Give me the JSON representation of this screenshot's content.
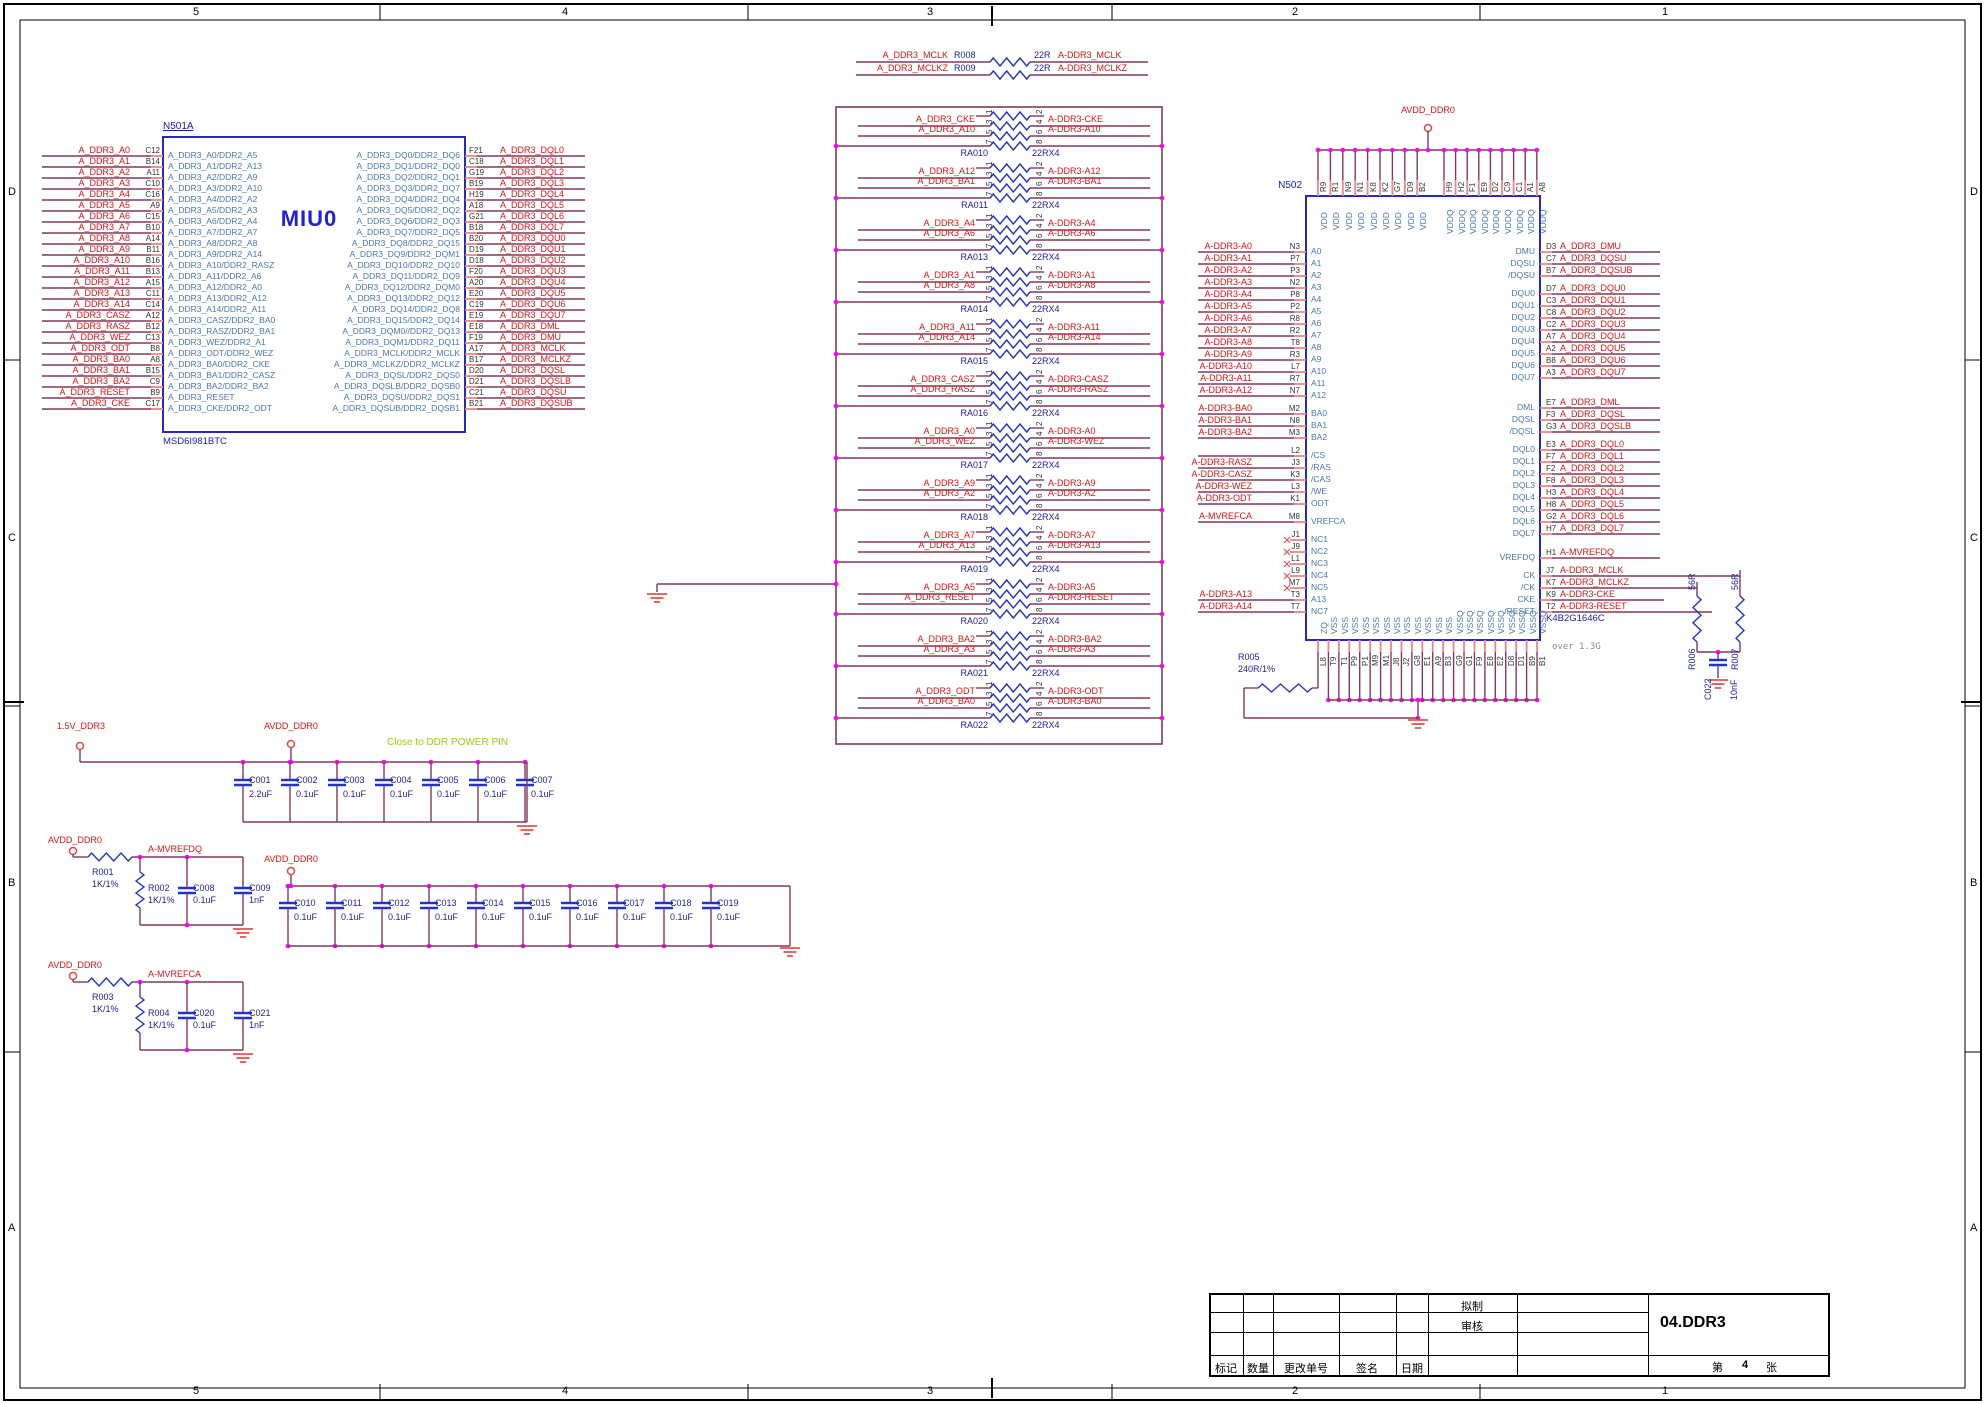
{
  "frame": {
    "zone_numbers": [
      "5",
      "4",
      "3",
      "2",
      "1"
    ],
    "zone_letters": [
      "D",
      "C",
      "B",
      "A"
    ]
  },
  "miu0": {
    "designator": "N501A",
    "title": "MIU0",
    "part": "MSD6I981BTC",
    "left_pins": [
      {
        "net": "A_DDR3_A0",
        "pin": "C12",
        "fn": "A_DDR3_A0/DDR2_A5"
      },
      {
        "net": "A_DDR3_A1",
        "pin": "B14",
        "fn": "A_DDR3_A1/DDR2_A13"
      },
      {
        "net": "A_DDR3_A2",
        "pin": "A11",
        "fn": "A_DDR3_A2/DDR2_A9"
      },
      {
        "net": "A_DDR3_A3",
        "pin": "C10",
        "fn": "A_DDR3_A3/DDR2_A10"
      },
      {
        "net": "A_DDR3_A4",
        "pin": "C16",
        "fn": "A_DDR3_A4/DDR2_A2"
      },
      {
        "net": "A_DDR3_A5",
        "pin": "A9",
        "fn": "A_DDR3_A5/DDR2_A3"
      },
      {
        "net": "A_DDR3_A6",
        "pin": "C15",
        "fn": "A_DDR3_A6/DDR2_A4"
      },
      {
        "net": "A_DDR3_A7",
        "pin": "B10",
        "fn": "A_DDR3_A7/DDR2_A7"
      },
      {
        "net": "A_DDR3_A8",
        "pin": "A14",
        "fn": "A_DDR3_A8/DDR2_A8"
      },
      {
        "net": "A_DDR3_A9",
        "pin": "B11",
        "fn": "A_DDR3_A9/DDR2_A14"
      },
      {
        "net": "A_DDR3_A10",
        "pin": "B16",
        "fn": "A_DDR3_A10/DDR2_RASZ"
      },
      {
        "net": "A_DDR3_A11",
        "pin": "B13",
        "fn": "A_DDR3_A11/DDR2_A6"
      },
      {
        "net": "A_DDR3_A12",
        "pin": "A15",
        "fn": "A_DDR3_A12/DDR2_A0"
      },
      {
        "net": "A_DDR3_A13",
        "pin": "C11",
        "fn": "A_DDR3_A13/DDR2_A12"
      },
      {
        "net": "A_DDR3_A14",
        "pin": "C14",
        "fn": "A_DDR3_A14/DDR2_A11"
      },
      {
        "net": "A_DDR3_CASZ",
        "pin": "A12",
        "fn": "A_DDR3_CASZ/DDR2_BA0"
      },
      {
        "net": "A_DDR3_RASZ",
        "pin": "B12",
        "fn": "A_DDR3_RASZ/DDR2_BA1"
      },
      {
        "net": "A_DDR3_WEZ",
        "pin": "C13",
        "fn": "A_DDR3_WEZ/DDR2_A1"
      },
      {
        "net": "A_DDR3_ODT",
        "pin": "B8",
        "fn": "A_DDR3_ODT/DDR2_WEZ"
      },
      {
        "net": "A_DDR3_BA0",
        "pin": "A8",
        "fn": "A_DDR3_BA0/DDR2_CKE"
      },
      {
        "net": "A_DDR3_BA1",
        "pin": "B15",
        "fn": "A_DDR3_BA1/DDR2_CASZ"
      },
      {
        "net": "A_DDR3_BA2",
        "pin": "C9",
        "fn": "A_DDR3_BA2/DDR2_BA2"
      },
      {
        "net": "A_DDR3_RESET",
        "pin": "B9",
        "fn": "A_DDR3_RESET"
      },
      {
        "net": "A_DDR3_CKE",
        "pin": "C17",
        "fn": "A_DDR3_CKE/DDR2_ODT"
      }
    ],
    "right_pins": [
      {
        "fn": "A_DDR3_DQ0/DDR2_DQ6",
        "pin": "F21",
        "net": "A_DDR3_DQL0"
      },
      {
        "fn": "A_DDR3_DQ1/DDR2_DQ0",
        "pin": "C18",
        "net": "A_DDR3_DQL1"
      },
      {
        "fn": "A_DDR3_DQ2/DDR2_DQ1",
        "pin": "G19",
        "net": "A_DDR3_DQL2"
      },
      {
        "fn": "A_DDR3_DQ3/DDR2_DQ7",
        "pin": "B19",
        "net": "A_DDR3_DQL3"
      },
      {
        "fn": "A_DDR3_DQ4/DDR2_DQ4",
        "pin": "H19",
        "net": "A_DDR3_DQL4"
      },
      {
        "fn": "A_DDR3_DQ5/DDR2_DQ2",
        "pin": "A18",
        "net": "A_DDR3_DQL5"
      },
      {
        "fn": "A_DDR3_DQ6/DDR2_DQ3",
        "pin": "G21",
        "net": "A_DDR3_DQL6"
      },
      {
        "fn": "A_DDR3_DQ7/DDR2_DQ5",
        "pin": "B18",
        "net": "A_DDR3_DQL7"
      },
      {
        "fn": "A_DDR3_DQ8/DDR2_DQ15",
        "pin": "B20",
        "net": "A_DDR3_DQU0"
      },
      {
        "fn": "A_DDR3_DQ9/DDR2_DQM1",
        "pin": "D19",
        "net": "A_DDR3_DQU1"
      },
      {
        "fn": "A_DDR3_DQ10/DDR2_DQ10",
        "pin": "D18",
        "net": "A_DDR3_DQU2"
      },
      {
        "fn": "A_DDR3_DQ11/DDR2_DQ9",
        "pin": "F20",
        "net": "A_DDR3_DQU3"
      },
      {
        "fn": "A_DDR3_DQ12/DDR2_DQM0",
        "pin": "A20",
        "net": "A_DDR3_DQU4"
      },
      {
        "fn": "A_DDR3_DQ13/DDR2_DQ12",
        "pin": "E20",
        "net": "A_DDR3_DQU5"
      },
      {
        "fn": "A_DDR3_DQ14/DDR2_DQ8",
        "pin": "C19",
        "net": "A_DDR3_DQU6"
      },
      {
        "fn": "A_DDR3_DQ15/DDR2_DQ14",
        "pin": "E19",
        "net": "A_DDR3_DQU7"
      },
      {
        "fn": "A_DDR3_DQM0//DDR2_DQ13",
        "pin": "E18",
        "net": "A_DDR3_DML"
      },
      {
        "fn": "A_DDR3_DQM1/DDR2_DQ11",
        "pin": "F19",
        "net": "A_DDR3_DMU"
      },
      {
        "fn": "A_DDR3_MCLK/DDR2_MCLK",
        "pin": "A17",
        "net": "A_DDR3_MCLK"
      },
      {
        "fn": "A_DDR3_MCLKZ/DDR2_MCLKZ",
        "pin": "B17",
        "net": "A_DDR3_MCLKZ"
      },
      {
        "fn": "A_DDR3_DQSL/DDR2_DQS0",
        "pin": "D20",
        "net": "A_DDR3_DQSL"
      },
      {
        "fn": "A_DDR3_DQSLB/DDR2_DQSB0",
        "pin": "D21",
        "net": "A_DDR3_DQSLB"
      },
      {
        "fn": "A_DDR3_DQSU/DDR2_DQS1",
        "pin": "C21",
        "net": "A_DDR3_DQSU"
      },
      {
        "fn": "A_DDR3_DQSUB/DDR2_DQSB1",
        "pin": "B21",
        "net": "A_DDR3_DQSUB"
      }
    ]
  },
  "series_resistors": [
    {
      "ref": "R008",
      "value": "22R",
      "from": "A_DDR3_MCLK",
      "to": "A-DDR3_MCLK"
    },
    {
      "ref": "R009",
      "value": "22R",
      "from": "A_DDR3_MCLKZ",
      "to": "A-DDR3_MCLKZ"
    }
  ],
  "network_pin_numbers": [
    "1",
    "2",
    "3",
    "4",
    "5",
    "6",
    "7",
    "8"
  ],
  "resistor_networks": [
    {
      "ref": "RA010",
      "value": "22RX4",
      "rows": [
        {
          "from": "A_DDR3_CKE",
          "to": "A-DDR3-CKE"
        },
        {
          "from": "A_DDR3_A10",
          "to": "A-DDR3-A10"
        }
      ]
    },
    {
      "ref": "RA011",
      "value": "22RX4",
      "rows": [
        {
          "from": "A_DDR3_A12",
          "to": "A-DDR3-A12"
        },
        {
          "from": "A_DDR3_BA1",
          "to": "A-DDR3-BA1"
        }
      ]
    },
    {
      "ref": "RA013",
      "value": "22RX4",
      "rows": [
        {
          "from": "A_DDR3_A4",
          "to": "A-DDR3-A4"
        },
        {
          "from": "A_DDR3_A6",
          "to": "A-DDR3-A6"
        }
      ]
    },
    {
      "ref": "RA014",
      "value": "22RX4",
      "rows": [
        {
          "from": "A_DDR3_A1",
          "to": "A-DDR3-A1"
        },
        {
          "from": "A_DDR3_A8",
          "to": "A-DDR3-A8"
        }
      ]
    },
    {
      "ref": "RA015",
      "value": "22RX4",
      "rows": [
        {
          "from": "A_DDR3_A11",
          "to": "A-DDR3-A11"
        },
        {
          "from": "A_DDR3_A14",
          "to": "A-DDR3-A14"
        }
      ]
    },
    {
      "ref": "RA016",
      "value": "22RX4",
      "rows": [
        {
          "from": "A_DDR3_CASZ",
          "to": "A-DDR3-CASZ"
        },
        {
          "from": "A_DDR3_RASZ",
          "to": "A-DDR3-RASZ"
        }
      ]
    },
    {
      "ref": "RA017",
      "value": "22RX4",
      "rows": [
        {
          "from": "A_DDR3_A0",
          "to": "A-DDR3-A0"
        },
        {
          "from": "A_DDR3_WEZ",
          "to": "A-DDR3-WEZ"
        }
      ]
    },
    {
      "ref": "RA018",
      "value": "22RX4",
      "rows": [
        {
          "from": "A_DDR3_A9",
          "to": "A-DDR3-A9"
        },
        {
          "from": "A_DDR3_A2",
          "to": "A-DDR3-A2"
        }
      ]
    },
    {
      "ref": "RA019",
      "value": "22RX4",
      "rows": [
        {
          "from": "A_DDR3_A7",
          "to": "A-DDR3-A7"
        },
        {
          "from": "A_DDR3_A13",
          "to": "A-DDR3-A13"
        }
      ]
    },
    {
      "ref": "RA020",
      "value": "22RX4",
      "rows": [
        {
          "from": "A_DDR3_A5",
          "to": "A-DDR3-A5"
        },
        {
          "from": "A_DDR3_RESET",
          "to": "A-DDR3-RESET"
        }
      ]
    },
    {
      "ref": "RA021",
      "value": "22RX4",
      "rows": [
        {
          "from": "A_DDR3_BA2",
          "to": "A-DDR3-BA2"
        },
        {
          "from": "A_DDR3_A3",
          "to": "A-DDR3-A3"
        }
      ]
    },
    {
      "ref": "RA022",
      "value": "22RX4",
      "rows": [
        {
          "from": "A_DDR3_ODT",
          "to": "A-DDR3-ODT"
        },
        {
          "from": "A_DDR3_BA0",
          "to": "A-DDR3-BA0"
        }
      ]
    }
  ],
  "ddr": {
    "designator": "N502",
    "part": "K4B2G1646C",
    "note": "over 1.3G",
    "power_net": "AVDD_DDR0",
    "vdd": {
      "fn": "VDD",
      "pins": [
        "R9",
        "R1",
        "N9",
        "N1",
        "K8",
        "K2",
        "G7",
        "D9",
        "B2"
      ]
    },
    "vddq": {
      "fn": "VDDQ",
      "pins": [
        "H9",
        "H2",
        "F1",
        "E9",
        "D2",
        "C9",
        "C1",
        "A1",
        "A8"
      ]
    },
    "left_groups": [
      [
        {
          "net": "A-DDR3-A0",
          "pin": "N3",
          "fn": "A0"
        },
        {
          "net": "A-DDR3-A1",
          "pin": "P7",
          "fn": "A1"
        },
        {
          "net": "A-DDR3-A2",
          "pin": "P3",
          "fn": "A2"
        },
        {
          "net": "A-DDR3-A3",
          "pin": "N2",
          "fn": "A3"
        },
        {
          "net": "A-DDR3-A4",
          "pin": "P8",
          "fn": "A4"
        },
        {
          "net": "A-DDR3-A5",
          "pin": "P2",
          "fn": "A5"
        },
        {
          "net": "A-DDR3-A6",
          "pin": "R8",
          "fn": "A6"
        },
        {
          "net": "A-DDR3-A7",
          "pin": "R2",
          "fn": "A7"
        },
        {
          "net": "A-DDR3-A8",
          "pin": "T8",
          "fn": "A8"
        },
        {
          "net": "A-DDR3-A9",
          "pin": "R3",
          "fn": "A9"
        },
        {
          "net": "A-DDR3-A10",
          "pin": "L7",
          "fn": "A10"
        },
        {
          "net": "A-DDR3-A11",
          "pin": "R7",
          "fn": "A11"
        },
        {
          "net": "A-DDR3-A12",
          "pin": "N7",
          "fn": "A12"
        }
      ],
      [
        {
          "net": "A-DDR3-BA0",
          "pin": "M2",
          "fn": "BA0"
        },
        {
          "net": "A-DDR3-BA1",
          "pin": "N8",
          "fn": "BA1"
        },
        {
          "net": "A-DDR3-BA2",
          "pin": "M3",
          "fn": "BA2"
        }
      ],
      [
        {
          "net": null,
          "pin": "L2",
          "fn": "/CS"
        },
        {
          "net": "A-DDR3-RASZ",
          "pin": "J3",
          "fn": "/RAS"
        },
        {
          "net": "A-DDR3-CASZ",
          "pin": "K3",
          "fn": "/CAS"
        },
        {
          "net": "A-DDR3-WEZ",
          "pin": "L3",
          "fn": "/WE"
        },
        {
          "net": "A-DDR3-ODT",
          "pin": "K1",
          "fn": "ODT"
        }
      ],
      [
        {
          "net": "A-MVREFCA",
          "pin": "M8",
          "fn": "VREFCA"
        }
      ],
      [
        {
          "net": null,
          "nc": true,
          "pin": "J1",
          "fn": "NC1"
        },
        {
          "net": null,
          "nc": true,
          "pin": "J9",
          "fn": "NC2"
        },
        {
          "net": null,
          "nc": true,
          "pin": "L1",
          "fn": "NC3"
        },
        {
          "net": null,
          "nc": true,
          "pin": "L9",
          "fn": "NC4"
        },
        {
          "net": null,
          "nc": true,
          "pin": "M7",
          "fn": "NC5"
        },
        {
          "net": "A-DDR3-A13",
          "pin": "T3",
          "fn": "A13"
        },
        {
          "net": "A-DDR3-A14",
          "pin": "T7",
          "fn": "NC7"
        }
      ]
    ],
    "right_groups": [
      [
        {
          "fn": "DMU",
          "pin": "D3",
          "net": "A_DDR3_DMU"
        },
        {
          "fn": "DQSU",
          "pin": "C7",
          "net": "A_DDR3_DQSU"
        },
        {
          "fn": "/DQSU",
          "pin": "B7",
          "net": "A_DDR3_DQSUB"
        }
      ],
      [
        {
          "fn": "DQU0",
          "pin": "D7",
          "net": "A_DDR3_DQU0"
        },
        {
          "fn": "DQU1",
          "pin": "C3",
          "net": "A_DDR3_DQU1"
        },
        {
          "fn": "DQU2",
          "pin": "C8",
          "net": "A_DDR3_DQU2"
        },
        {
          "fn": "DQU3",
          "pin": "C2",
          "net": "A_DDR3_DQU3"
        },
        {
          "fn": "DQU4",
          "pin": "A7",
          "net": "A_DDR3_DQU4"
        },
        {
          "fn": "DQU5",
          "pin": "A2",
          "net": "A_DDR3_DQU5"
        },
        {
          "fn": "DQU6",
          "pin": "B8",
          "net": "A_DDR3_DQU6"
        },
        {
          "fn": "DQU7",
          "pin": "A3",
          "net": "A_DDR3_DQU7"
        }
      ],
      [
        {
          "fn": "DML",
          "pin": "E7",
          "net": "A_DDR3_DML"
        },
        {
          "fn": "DQSL",
          "pin": "F3",
          "net": "A_DDR3_DQSL"
        },
        {
          "fn": "/DQSL",
          "pin": "G3",
          "net": "A_DDR3_DQSLB"
        }
      ],
      [
        {
          "fn": "DQL0",
          "pin": "E3",
          "net": "A_DDR3_DQL0"
        },
        {
          "fn": "DQL1",
          "pin": "F7",
          "net": "A_DDR3_DQL1"
        },
        {
          "fn": "DQL2",
          "pin": "F2",
          "net": "A_DDR3_DQL2"
        },
        {
          "fn": "DQL3",
          "pin": "F8",
          "net": "A_DDR3_DQL3"
        },
        {
          "fn": "DQL4",
          "pin": "H3",
          "net": "A_DDR3_DQL4"
        },
        {
          "fn": "DQL5",
          "pin": "H8",
          "net": "A_DDR3_DQL5"
        },
        {
          "fn": "DQL6",
          "pin": "G2",
          "net": "A_DDR3_DQL6"
        },
        {
          "fn": "DQL7",
          "pin": "H7",
          "net": "A_DDR3_DQL7"
        }
      ],
      [
        {
          "fn": "VREFDQ",
          "pin": "H1",
          "net": "A-MVREFDQ"
        }
      ],
      [
        {
          "fn": "CK",
          "pin": "J7",
          "net": "A-DDR3_MCLK"
        },
        {
          "fn": "/CK",
          "pin": "K7",
          "net": "A-DDR3_MCLKZ"
        },
        {
          "fn": "CKE",
          "pin": "K9",
          "net": "A-DDR3-CKE"
        },
        {
          "fn": "/RESET",
          "pin": "T2",
          "net": "A-DDR3-RESET"
        }
      ]
    ],
    "zq": {
      "fn": "ZQ",
      "pin": "L8"
    },
    "vss": {
      "fn": "VSS",
      "pins": [
        "T9",
        "T1",
        "P9",
        "P1",
        "M9",
        "M1",
        "J8",
        "J2",
        "G8",
        "E1",
        "A9",
        "B3"
      ]
    },
    "vssq": {
      "fn": "VSSQ",
      "pins": [
        "G9",
        "G1",
        "F9",
        "E8",
        "E2",
        "D8",
        "D1",
        "B9",
        "B1"
      ]
    },
    "r_zq": {
      "ref": "R005",
      "value": "240R/1%"
    }
  },
  "termination": {
    "r_ckz": {
      "ref": "R006",
      "value": "56R"
    },
    "r_ck": {
      "ref": "R007",
      "value": "56R"
    },
    "cap": {
      "ref": "C022",
      "value": "10nF"
    }
  },
  "decoupling": {
    "note": "Close to DDR POWER PIN",
    "row1": {
      "power_left": "1.5V_DDR3",
      "power_mid": "AVDD_DDR0",
      "caps": [
        {
          "ref": "C001",
          "value": "2.2uF"
        },
        {
          "ref": "C002",
          "value": "0.1uF"
        },
        {
          "ref": "C003",
          "value": "0.1uF"
        },
        {
          "ref": "C004",
          "value": "0.1uF"
        },
        {
          "ref": "C005",
          "value": "0.1uF"
        },
        {
          "ref": "C006",
          "value": "0.1uF"
        },
        {
          "ref": "C007",
          "value": "0.1uF"
        }
      ]
    },
    "row2": {
      "power": "AVDD_DDR0",
      "caps": [
        {
          "ref": "C010",
          "value": "0.1uF"
        },
        {
          "ref": "C011",
          "value": "0.1uF"
        },
        {
          "ref": "C012",
          "value": "0.1uF"
        },
        {
          "ref": "C013",
          "value": "0.1uF"
        },
        {
          "ref": "C014",
          "value": "0.1uF"
        },
        {
          "ref": "C015",
          "value": "0.1uF"
        },
        {
          "ref": "C016",
          "value": "0.1uF"
        },
        {
          "ref": "C017",
          "value": "0.1uF"
        },
        {
          "ref": "C018",
          "value": "0.1uF"
        },
        {
          "ref": "C019",
          "value": "0.1uF"
        }
      ]
    }
  },
  "vref": [
    {
      "power": "AVDD_DDR0",
      "out": "A-MVREFDQ",
      "r_series": {
        "ref": "R001",
        "value": "1K/1%"
      },
      "r_shunt": {
        "ref": "R002",
        "value": "1K/1%"
      },
      "c1": {
        "ref": "C008",
        "value": "0.1uF"
      },
      "c2": {
        "ref": "C009",
        "value": "1nF"
      }
    },
    {
      "power": "AVDD_DDR0",
      "out": "A-MVREFCA",
      "r_series": {
        "ref": "R003",
        "value": "1K/1%"
      },
      "r_shunt": {
        "ref": "R004",
        "value": "1K/1%"
      },
      "c1": {
        "ref": "C020",
        "value": "0.1uF"
      },
      "c2": {
        "ref": "C021",
        "value": "1nF"
      }
    }
  ],
  "title_block": {
    "drafted_label": "拟制",
    "reviewed_label": "审核",
    "mark_label": "标记",
    "qty_label": "数量",
    "change_label": "更改单号",
    "sign_label": "签名",
    "date_label": "日期",
    "doc_number": "04.DDR3",
    "sheet_prefix": "第",
    "sheet_number": "4",
    "sheet_suffix": "张"
  }
}
